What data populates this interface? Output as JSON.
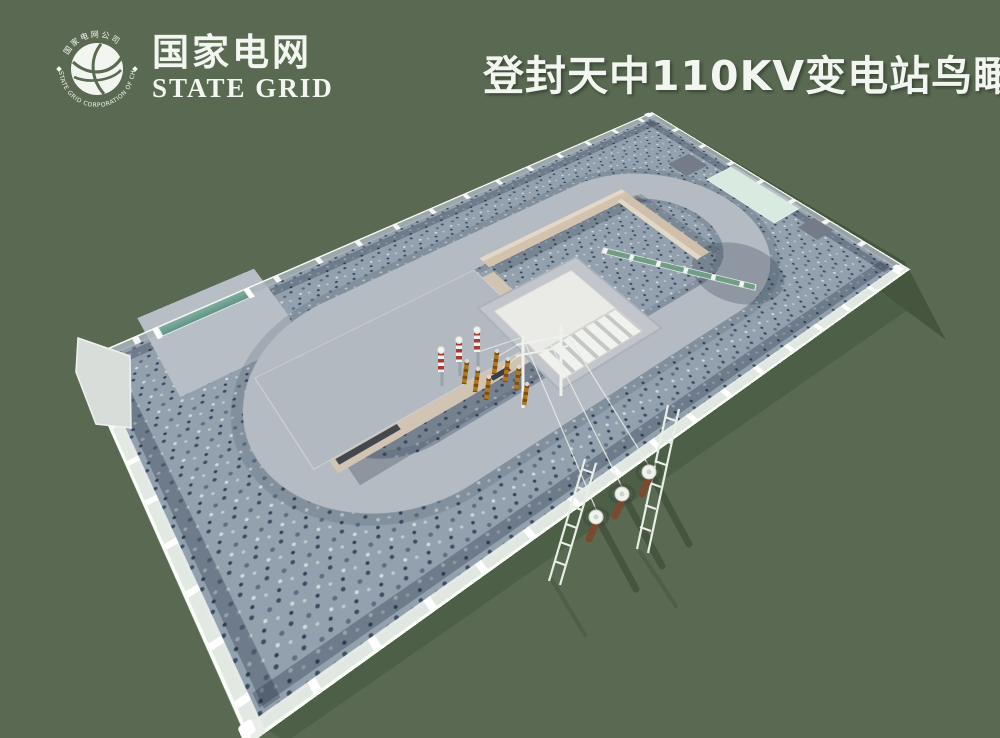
{
  "page": {
    "width": 1000,
    "height": 738,
    "background": "#5a6a52"
  },
  "header": {
    "title": "登封天中110KV变电站鸟瞰图",
    "logo": {
      "name_cn": "国家电网",
      "name_en": "STATE GRID",
      "emblem_text_top": "国家电网公司",
      "emblem_text_bottom": "STATE GRID CORPORATION OF CHINA"
    }
  },
  "scene": {
    "subject": "Aerial bird's-eye 3D rendering of a fenced 110 kV substation compound",
    "colors": {
      "background": "#5a6a52",
      "cast_shadow": "#46553e",
      "gravel_base": "#93a0ad",
      "gravel_dark_fleck": "#3c4e63",
      "gravel_light_fleck": "#d2d9de",
      "loop_road": "#b5bbc3",
      "drain_trench": "#2c3a4c",
      "building_roof": "#b3b9c0",
      "building_wall_tan": "#d2c4b3",
      "firewall_top": "#e2d8c8",
      "fence_white": "#f3f5f1",
      "fence_mesh_gray": "#aab3ba",
      "gate_teal": "#6fa493",
      "mint_pad": "#d9ebe1",
      "switch_panel_green": "#6f9e85",
      "equipment_pad_dark": "#747c89",
      "transformer_white": "#eaebe7",
      "radiator_gray": "#c3c7c6",
      "bushing_amber": "#b0771c",
      "arrester_red": "#a83a30",
      "pole_brown": "#7a4a2e"
    },
    "elements": [
      {
        "name": "perimeter-fence",
        "desc": "white-post fence on low wall around rectangular compound"
      },
      {
        "name": "entrance-gate",
        "desc": "teal sliding gate on northwest wall near west corner"
      },
      {
        "name": "loop-road",
        "desc": "light gray ring road looping around the main building"
      },
      {
        "name": "gravel-yard",
        "desc": "blue-gray crushed-stone ground cover"
      },
      {
        "name": "main-building",
        "desc": "flat-roof building with tan brick walls"
      },
      {
        "name": "firewall",
        "desc": "tan masonry L-wall enclosing the transformer bay"
      },
      {
        "name": "main-transformer",
        "desc": "white transformer with radiator banks",
        "bushing_count": 7
      },
      {
        "name": "surge-arresters",
        "desc": "red-white striped arresters on gray pedestals",
        "count": 3
      },
      {
        "name": "switch-screen",
        "desc": "white frame with green panels beside transformer bay"
      },
      {
        "name": "gantry",
        "desc": "white take-off gantry frame near southeast fence"
      },
      {
        "name": "equipment-pads",
        "desc": "dark concrete pads in gravel",
        "count": 2
      },
      {
        "name": "mint-pad",
        "desc": "pale green rectangular pad along northeast fence"
      },
      {
        "name": "terminal-poles",
        "desc": "brown poles with white caps outside southeast fence",
        "count": 3
      },
      {
        "name": "lattice-supports",
        "desc": "white lattice ladder frames outside fence",
        "count": 2
      },
      {
        "name": "overhead-lines",
        "desc": "conductors from gantry over fence to terminal poles"
      }
    ]
  }
}
